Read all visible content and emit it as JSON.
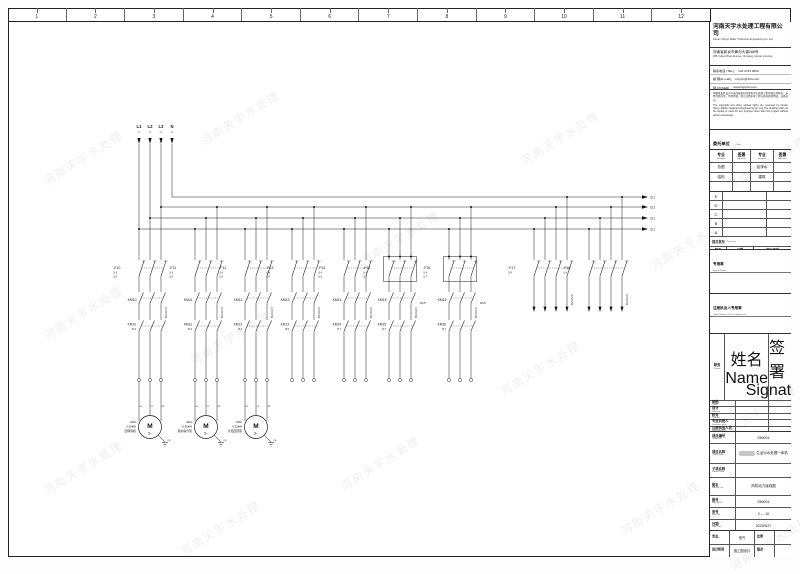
{
  "page": {
    "watermark": "河南天宇水处理",
    "zone_numbers": [
      "1",
      "2",
      "3",
      "4",
      "5",
      "6",
      "7",
      "8",
      "9",
      "10",
      "11",
      "12"
    ]
  },
  "company": {
    "name": "河南天宇水处理工程有限公司",
    "name_en": "Henan Tianyu Water Treatment Engineering Co.,Ltd.",
    "addr_cn": "河南省新乡市黄河大道288号",
    "addr_en": "288 Yellow River Avenue, Xinxiang, Henan province",
    "contacts": [
      {
        "label": "联系电话 (TEL)",
        "value": "133 3733 0666"
      },
      {
        "label": "邮  箱(E-mail)",
        "value": "xxtyscl@163.com"
      },
      {
        "label": "网  址(WEB)",
        "value": "www.hgtyscl.com"
      }
    ]
  },
  "disclaimer": {
    "cn": "本图纸及其设计内容的版权归河南天宇水处理工程有限公司所有，未经书面许可，不得复制、转让或用于本工程以外的其他用途，违者必究。",
    "en": "The copyright and other related rights are reserved by Henan Tianyu Water Treatment Engineering Co.,Ltd. The drawing shall not be copied or used for any purpose other than this project without written permission."
  },
  "client": {
    "cn": "委托单位",
    "en": "Client",
    "suffix": "有限公司"
  },
  "discipline_table": {
    "headers": [
      {
        "cn": "专业",
        "en": "Discipline"
      },
      {
        "cn": "签署",
        "en": "Signature"
      },
      {
        "cn": "专业",
        "en": "Discipline"
      },
      {
        "cn": "签署",
        "en": "Signature"
      }
    ],
    "rows": [
      [
        "总图",
        "",
        "给排水",
        ""
      ],
      [
        "结构",
        "",
        "建筑",
        ""
      ],
      [
        "",
        "",
        "",
        ""
      ]
    ]
  },
  "revision_table": {
    "letters": [
      "E",
      "D",
      "C",
      "B",
      "A"
    ],
    "issue_cn": "首次发布",
    "issue_en": "First Issue",
    "headers": [
      {
        "cn": "版次",
        "en": "Revised"
      },
      {
        "cn": "日期",
        "en": "Issue Date"
      },
      {
        "cn": "发行说明",
        "en": "Issued Note"
      }
    ]
  },
  "stamps": [
    {
      "cn": "专用章",
      "en": "Special Stamp"
    },
    {
      "cn": "注册执业人专用章",
      "en": "Special Stamp Of Person Registered"
    }
  ],
  "personnel": {
    "headers": [
      {
        "cn": "职务",
        "en": "Position"
      },
      {
        "cn": "姓名",
        "en": "Name"
      },
      {
        "cn": "签署",
        "en": "Signature"
      }
    ],
    "rows": [
      {
        "cn": "制图",
        "en": "Drawn"
      },
      {
        "cn": "设计",
        "en": "Designed"
      },
      {
        "cn": "校对",
        "en": "Checked"
      },
      {
        "cn": "专业负责人",
        "en": "Discipline Leader"
      },
      {
        "cn": "注册执业人员",
        "en": "Registered Staff"
      },
      {
        "cn": "审核",
        "en": "Reviewed"
      },
      {
        "cn": "审定",
        "en": "Approved"
      },
      {
        "cn": "项目负责人",
        "en": "Project Leader"
      }
    ]
  },
  "project_rows": [
    {
      "cn": "项目编号",
      "en": "Project No.",
      "value": "S60001",
      "redact": false
    },
    {
      "cn": "项目名称",
      "en": "Project Name",
      "value": "生活污水处理一体机",
      "redact": true
    },
    {
      "cn": "子项名称",
      "en": "Subitem Name",
      "value": "",
      "redact": false
    },
    {
      "cn": "图名",
      "en": "Drawing Title",
      "value": "风机动力接线图",
      "redact": false
    },
    {
      "cn": "图号",
      "en": "Drawing No.",
      "value": "S60001",
      "redact": false
    },
    {
      "cn": "张号",
      "en": "Sheet No.",
      "value": "2 — 10",
      "redact": false
    },
    {
      "cn": "日期",
      "en": "Issue Date",
      "value": "2023/5/27",
      "redact": false
    }
  ],
  "project_split_rows": [
    {
      "l_cn": "专业",
      "l_en": "Discipline",
      "l_val": "电气",
      "r_cn": "比例",
      "r_en": "Scale",
      "r_val": ""
    },
    {
      "l_cn": "设计阶段",
      "l_en": "Design Phase",
      "l_val": "施工图设计",
      "r_cn": "版次",
      "r_en": "Edition",
      "r_val": ""
    }
  ],
  "schematic": {
    "phases": [
      {
        "label": "L1",
        "ref": "1.1"
      },
      {
        "label": "L2",
        "ref": "1.1"
      },
      {
        "label": "L3",
        "ref": "1.1"
      },
      {
        "label": "N",
        "ref": "1.1"
      }
    ],
    "bus_arrow_refs": [
      "/3.1",
      "/3.1",
      "/3.1",
      "/3.1"
    ],
    "motor_terminals": [
      "U1",
      "V1",
      "W1"
    ],
    "pe_label": "PE",
    "motor_glyph": "M",
    "motor_phase_glyph": "3~",
    "feeders": [
      {
        "id": "-F10",
        "refs": [
          "/1.4",
          "/1.6"
        ],
        "cable": "BV-3×1.5",
        "km": "KM10",
        "km2_ref": "/5.4",
        "motor": {
          "id": "-M10",
          "power": "0.25kW",
          "name": "回转风机"
        }
      },
      {
        "id": "-F11",
        "refs": [
          "/1.4",
          "/1.6"
        ],
        "cable": "BV-3×1.5",
        "km": "KM11",
        "km2_ref": "/5.4",
        "motor": {
          "id": "-M11",
          "power": "0.55kW",
          "name": "潜水提升泵"
        }
      },
      {
        "id": "-F12",
        "refs": [
          "/1.4",
          "/1.6"
        ],
        "cable": "BV-3×1.5",
        "km": "KM12",
        "km2_ref": "/5.4",
        "motor": {
          "id": "-M12",
          "power": "0.25kW",
          "name": "污泥回流泵"
        }
      },
      {
        "id": "-F13",
        "refs": [
          "/1.4",
          "/1.6"
        ],
        "cable": "BV-3×2.5",
        "km": "KM13",
        "km2_ref": "/5.5"
      },
      {
        "id": "-F14",
        "refs": [
          "/1.4",
          "/1.6"
        ],
        "cable": "BV-3×2.5",
        "km": "KM14",
        "km2_ref": "/5.7"
      },
      {
        "id": "-F15",
        "refs": [
          "/1.4",
          "/1.7"
        ],
        "cable": "BV-3×2.5",
        "km": "KM15",
        "aux": "N15",
        "km2_ref": "/5.7",
        "boxed": true
      },
      {
        "id": "-F16",
        "refs": [
          "/1.4",
          "/1.7"
        ],
        "cable": "BV-3×2.5",
        "km": "KM16",
        "aux": "N16",
        "km2_ref": "/5.7",
        "boxed": true
      },
      {
        "id": "-F17",
        "refs": [
          "/1.4"
        ],
        "cable": "BV-3×2.5",
        "spare": true
      },
      {
        "id": "-F18",
        "refs": [
          "/1.4"
        ],
        "cable": "BV-3×2.5",
        "spare": true
      }
    ]
  }
}
